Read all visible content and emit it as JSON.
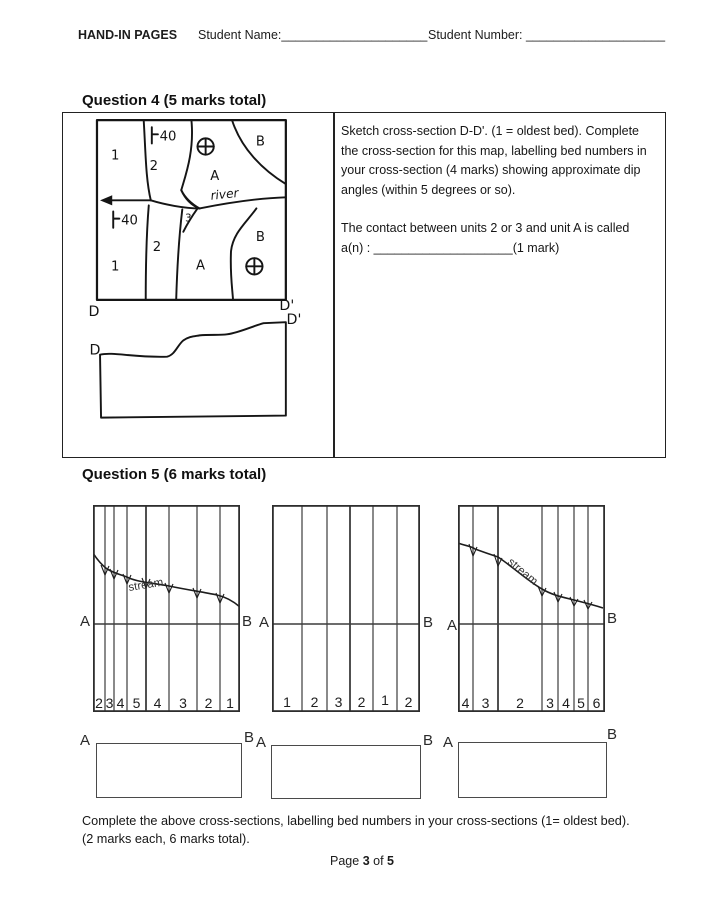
{
  "header": {
    "title": "HAND-IN PAGES",
    "name_label": "Student Name:",
    "name_line": "_____________________",
    "number_label": "Student Number:",
    "number_line": "____________________"
  },
  "q4": {
    "heading": "Question 4 (5 marks total)",
    "para1": "Sketch cross-section D-D'. (1 = oldest bed). Complete the cross-section for this map, labelling bed numbers in your cross-section (4 marks) showing approximate dip angles (within 5 degrees or so).",
    "para2": "The contact between units 2 or 3 and unit A  is called",
    "answer_prefix": "a(n) :",
    "answer_blank": "____________________",
    "answer_suffix": "(1 mark)",
    "sketch": {
      "dip_top": "40",
      "dip_left": "40",
      "unit1_top": "1",
      "unit2_top": "2",
      "unitA_top": "A",
      "unitB_top": "B",
      "unit3": "3",
      "unit2_bot": "2",
      "unit1_bot": "1",
      "unitA_bot": "A",
      "unitB_bot": "B",
      "river": "river",
      "d_map": "D",
      "dprime_map": "D'",
      "d_profile": "D",
      "dprime_profile": "D'"
    }
  },
  "q5": {
    "heading": "Question 5 (6 marks total)",
    "maps": [
      {
        "a": "A",
        "b": "B",
        "stream": "stream",
        "beds": [
          "2",
          "3",
          "4",
          "5",
          "4",
          "3",
          "2",
          "1"
        ]
      },
      {
        "a": "A",
        "b": "B",
        "beds": [
          "1",
          "2",
          "3",
          "2",
          "1",
          "2"
        ]
      },
      {
        "a": "A",
        "b": "B",
        "stream": "stream",
        "beds": [
          "4",
          "3",
          "2",
          "3",
          "4",
          "5",
          "6"
        ]
      }
    ],
    "boxes": [
      {
        "a": "A",
        "b": "B"
      },
      {
        "a": "A",
        "b": "B"
      },
      {
        "a": "A",
        "b": "B"
      }
    ],
    "line1": "Complete the above cross-sections, labelling bed numbers in your cross-sections (1= oldest bed).",
    "line2": "(2 marks each, 6 marks total)."
  },
  "footer": {
    "prefix": "Page",
    "num": "3",
    "middle": "of",
    "total": "5"
  }
}
